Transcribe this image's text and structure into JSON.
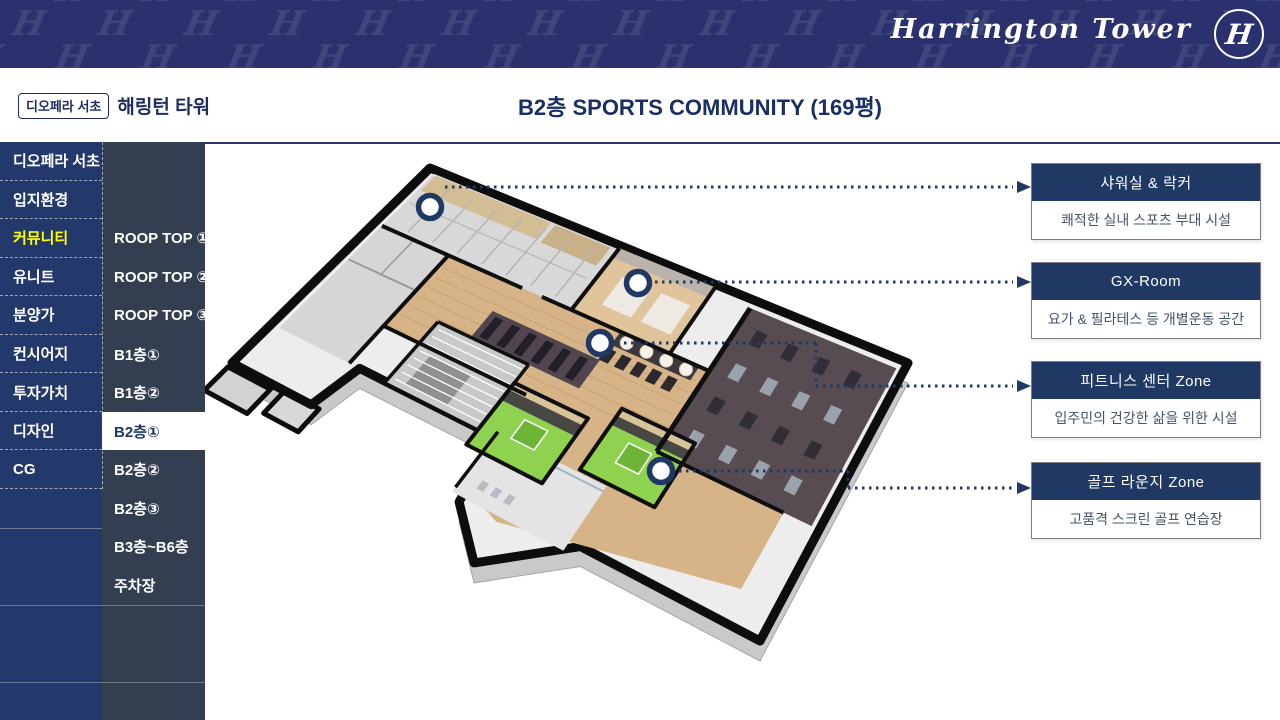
{
  "banner": {
    "logo_text": "Harrington Tower",
    "logo_monogram": "H",
    "pattern_letter": "H"
  },
  "header": {
    "badge": "디오페라 서초",
    "project": "해링턴 타워",
    "title": "B2층 SPORTS COMMUNITY (169평)"
  },
  "sidebar": {
    "primary": [
      {
        "label": "디오페라 서초"
      },
      {
        "label": "입지환경"
      },
      {
        "label": "커뮤니티",
        "highlight": true
      },
      {
        "label": "유니트"
      },
      {
        "label": "분양가"
      },
      {
        "label": "컨시어지"
      },
      {
        "label": "투자가치"
      },
      {
        "label": "디자인"
      },
      {
        "label": "CG"
      }
    ],
    "secondary": [
      {
        "label": "ROOP TOP ①"
      },
      {
        "label": "ROOP TOP ②"
      },
      {
        "label": "ROOP TOP ③"
      },
      {
        "label": "B1층①"
      },
      {
        "label": "B1층②"
      },
      {
        "label": "B2층①",
        "selected": true
      },
      {
        "label": "B2층②"
      },
      {
        "label": "B2층③"
      },
      {
        "label": "B3층~B6층"
      },
      {
        "label": "주차장"
      }
    ]
  },
  "callouts": [
    {
      "title": "샤워실 & 락커",
      "desc": "쾌적한 실내 스포츠 부대 시설"
    },
    {
      "title": "GX-Room",
      "desc": "요가 & 필라테스 등 개별운동 공간"
    },
    {
      "title": "피트니스 센터 Zone",
      "desc": "입주민의 건강한 삶을 위한 시설"
    },
    {
      "title": "골프 라운지 Zone",
      "desc": "고품격 스크린 골프 연습장"
    }
  ],
  "markers": [
    {
      "name": "shower-locker"
    },
    {
      "name": "gx-room"
    },
    {
      "name": "fitness-center"
    },
    {
      "name": "golf-lounge"
    }
  ],
  "colors": {
    "banner_navy": "#2A316E",
    "sidebar_primary": "#24396B",
    "sidebar_secondary": "#333F50",
    "highlight_yellow": "#FFFF00",
    "accent_navy": "#1F3864",
    "card_border": "#7F7F7F",
    "card_body_text": "#44546A",
    "wood_floor": "#D6B488",
    "gym_carpet": "#584C53",
    "golf_green": "#8FD24F"
  }
}
